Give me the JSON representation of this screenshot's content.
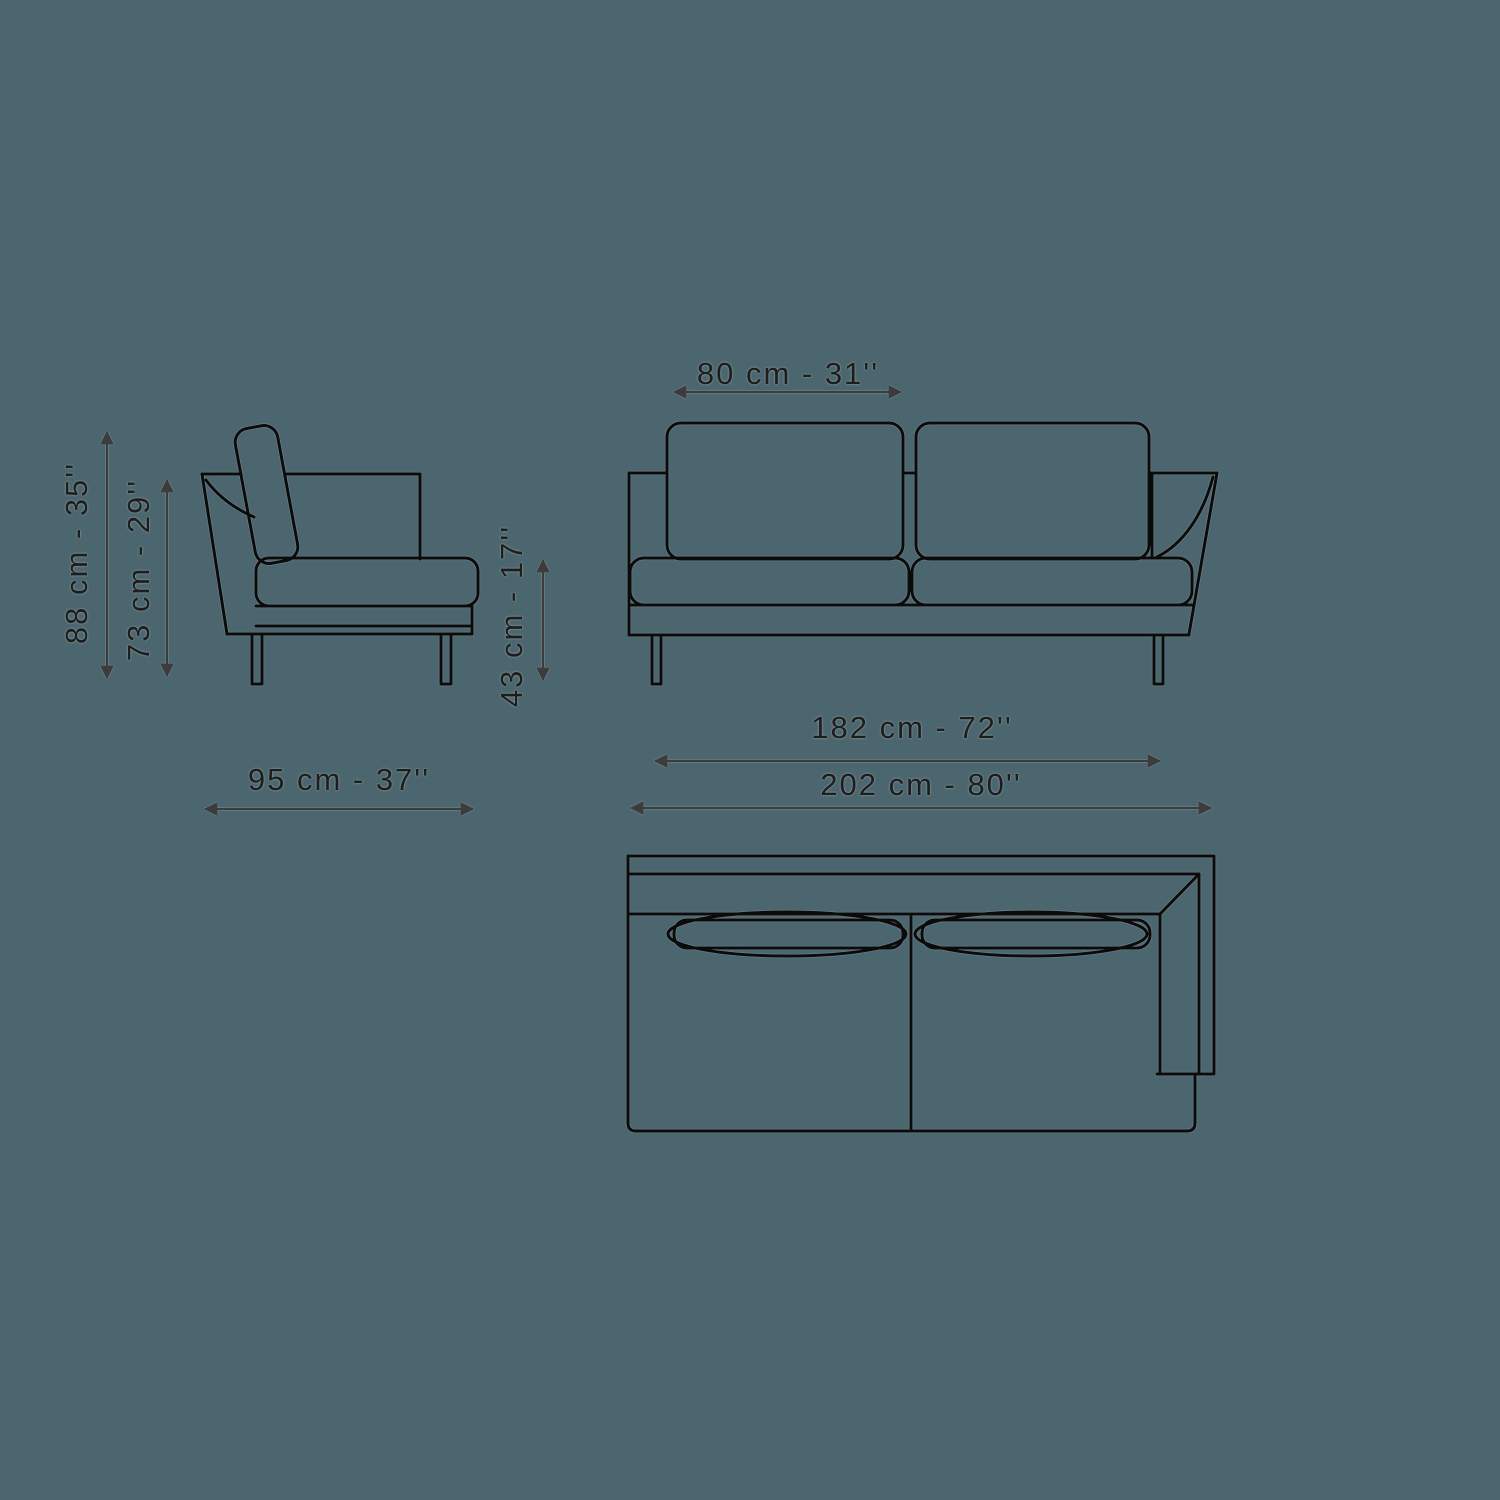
{
  "page": {
    "colors": {
      "background": "#4c666f",
      "line": "#0b0b0b",
      "text": "#1d1d1b",
      "arrow": "#3c3c3c"
    }
  },
  "diagram": {
    "dimensions": {
      "overall_height": {
        "label": "88 cm - 35''",
        "cm": 88,
        "inch": 35
      },
      "back_height": {
        "label": "73 cm - 29''",
        "cm": 73,
        "inch": 29
      },
      "depth": {
        "label": "95 cm - 37''",
        "cm": 95,
        "inch": 37
      },
      "seat_height": {
        "label": "43 cm - 17''",
        "cm": 43,
        "inch": 17
      },
      "back_cushion_width": {
        "label": "80 cm - 31''",
        "cm": 80,
        "inch": 31
      },
      "seat_width": {
        "label": "182 cm - 72''",
        "cm": 182,
        "inch": 72
      },
      "overall_width": {
        "label": "202 cm - 80''",
        "cm": 202,
        "inch": 80
      }
    }
  }
}
